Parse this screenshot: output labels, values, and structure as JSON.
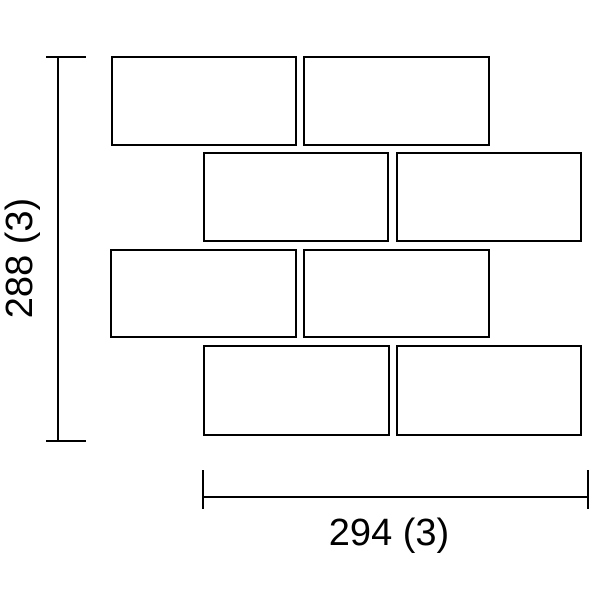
{
  "diagram": {
    "type": "tile-layout-drawing",
    "background_color": "#ffffff",
    "line_color": "#000000",
    "stroke_px": 2,
    "bricks": [
      {
        "x": 111,
        "y": 56,
        "w": 186,
        "h": 90
      },
      {
        "x": 303,
        "y": 56,
        "w": 187,
        "h": 90
      },
      {
        "x": 203,
        "y": 152,
        "w": 186,
        "h": 90
      },
      {
        "x": 396,
        "y": 152,
        "w": 186,
        "h": 90
      },
      {
        "x": 110,
        "y": 249,
        "w": 187,
        "h": 89
      },
      {
        "x": 303,
        "y": 249,
        "w": 187,
        "h": 89
      },
      {
        "x": 203,
        "y": 345,
        "w": 187,
        "h": 91
      },
      {
        "x": 396,
        "y": 345,
        "w": 186,
        "h": 91
      }
    ],
    "vertical_dimension": {
      "label": "288 (3)",
      "line": {
        "x": 57,
        "y1": 56,
        "y2": 442
      },
      "ticks": [
        {
          "x1": 46,
          "x2": 86,
          "y": 56
        },
        {
          "x1": 46,
          "x2": 86,
          "y": 440
        }
      ],
      "label_center": {
        "x": 20,
        "y": 258
      }
    },
    "horizontal_dimension": {
      "label": "294 (3)",
      "line": {
        "y": 496,
        "x1": 202,
        "x2": 588
      },
      "ticks": [
        {
          "x": 202,
          "y1": 470,
          "y2": 509
        },
        {
          "x": 587,
          "y1": 470,
          "y2": 509
        }
      ],
      "label_center": {
        "x": 389,
        "y": 533
      }
    }
  }
}
